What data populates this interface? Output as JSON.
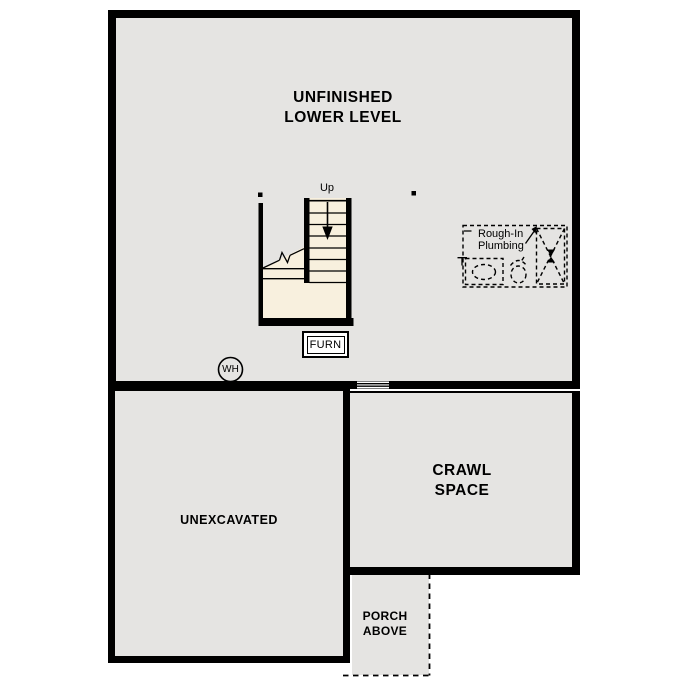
{
  "colors": {
    "wall": "#000000",
    "room_fill": "#e5e4e2",
    "stair_fill": "#f8f0de",
    "background": "#ffffff"
  },
  "plan": {
    "title": "UNFINISHED\nLOWER LEVEL",
    "stairs": {
      "up_label": "Up"
    },
    "plumbing": {
      "label": "Rough-In\nPlumbing"
    },
    "furnace": {
      "label": "FURN"
    },
    "water_heater": {
      "label": "WH"
    },
    "rooms": {
      "crawl": "CRAWL\nSPACE",
      "unexcavated": "UNEXCAVATED",
      "porch": "PORCH\nABOVE"
    }
  }
}
